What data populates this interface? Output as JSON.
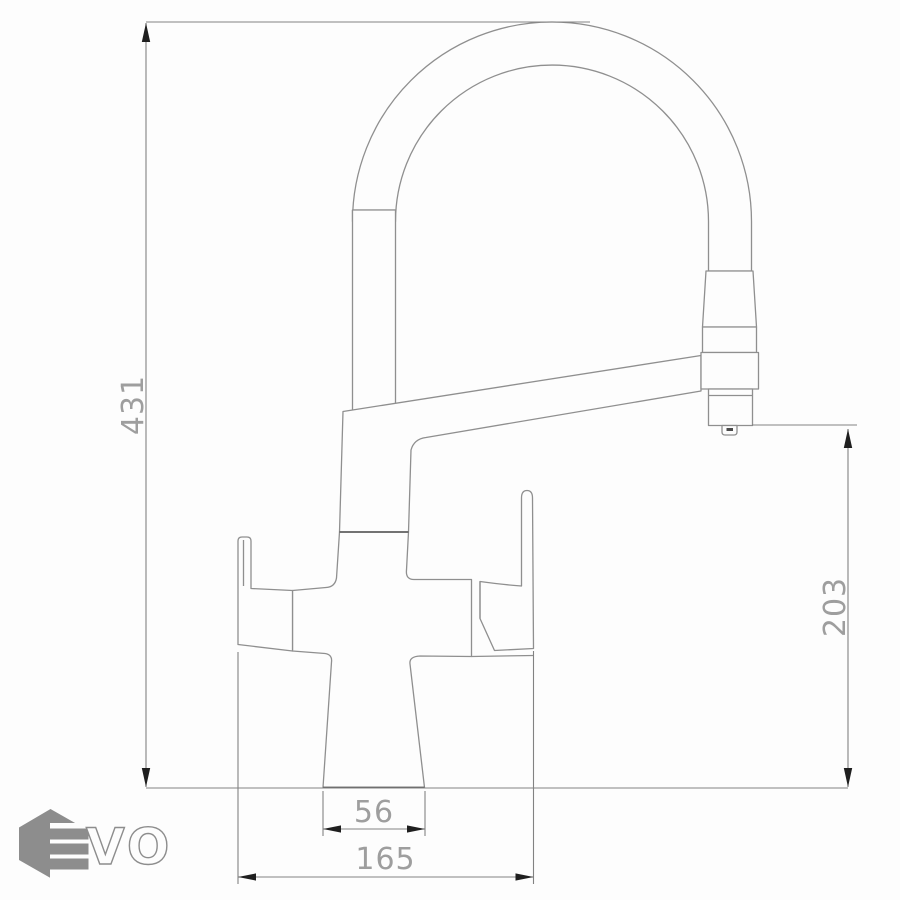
{
  "colors": {
    "paper": "#fdfdfd",
    "line": "#8f8f8f",
    "line-dark": "#5f5f5f",
    "dim-line": "#828282",
    "arrow": "#1f1f1f",
    "dim-text": "#9e9e9e",
    "logo": "#8d8d8d"
  },
  "drawing": {
    "type": "technical line drawing of a two-handle kitchen faucet with flexible gooseneck spring spout and pull-down spray head",
    "dimensions": {
      "overall_height": "431",
      "spout_outlet_height": "203",
      "body_base_width": "56",
      "overall_width": "165"
    }
  },
  "logo": {
    "text": "EVO",
    "vo_text": "VO"
  }
}
